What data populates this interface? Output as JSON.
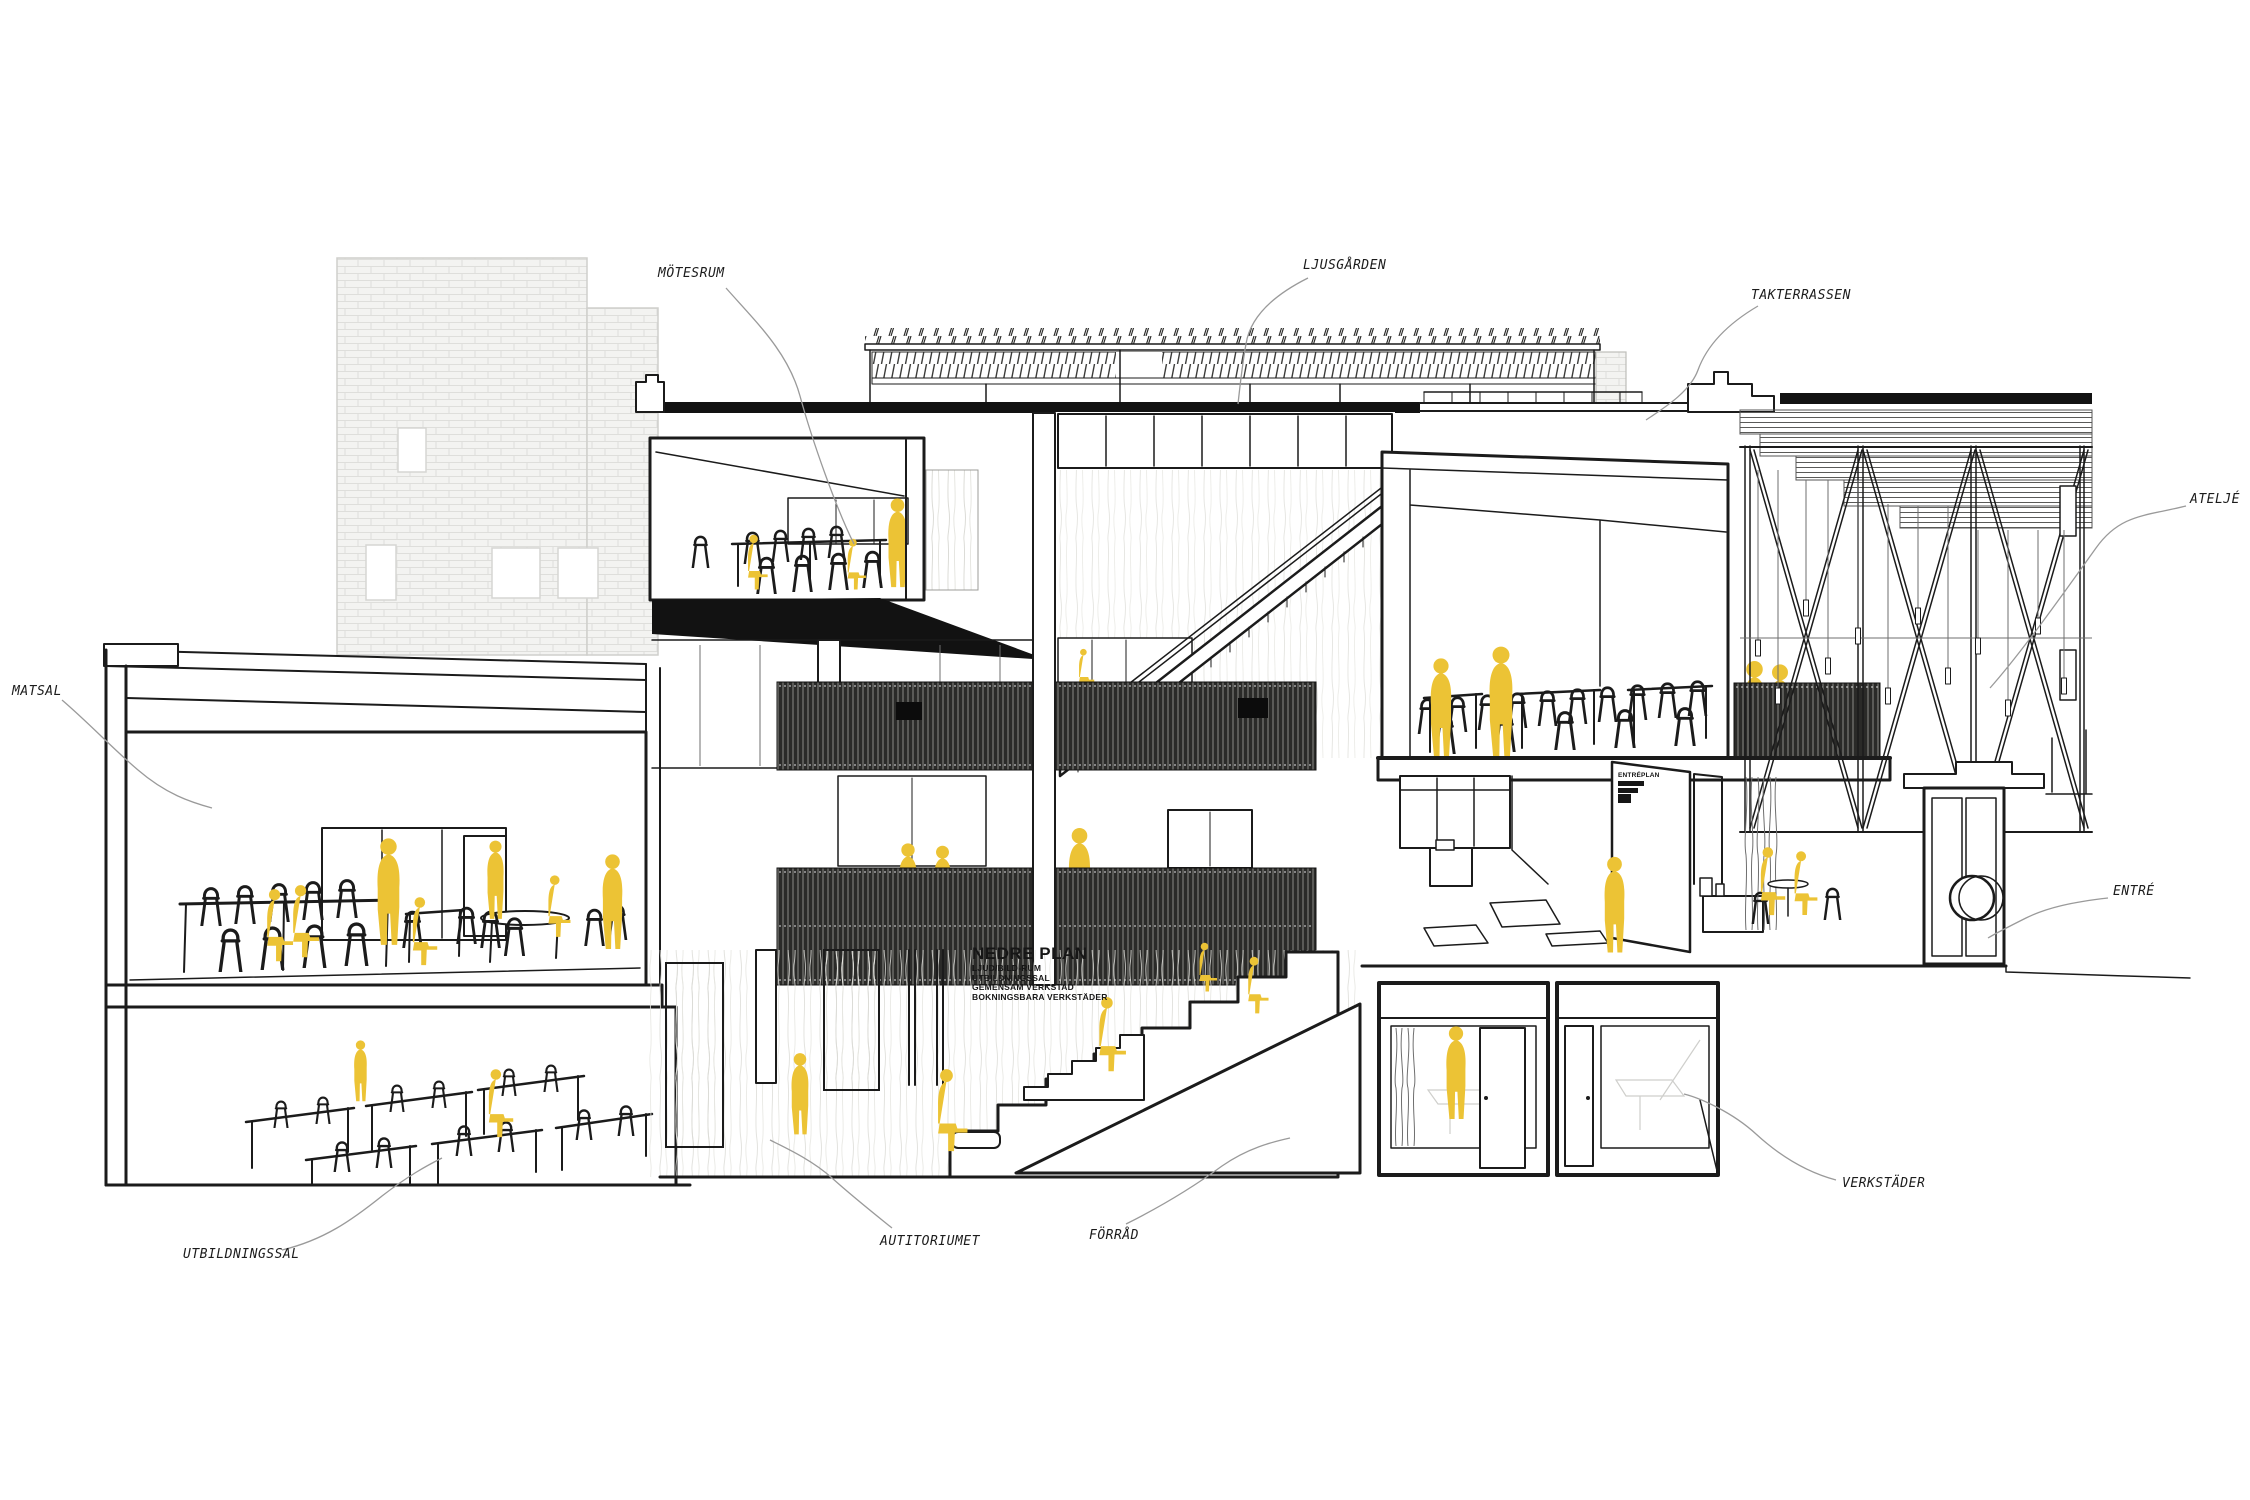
{
  "colors": {
    "accent": "#ecc335",
    "line": "#1b1b1b",
    "band": "#2a2a28",
    "leader": "#9a9a9a",
    "brick": "#f3f3f1"
  },
  "labels": [
    {
      "id": "matsal",
      "text": "MATSAL"
    },
    {
      "id": "motesrum",
      "text": "MÖTESRUM"
    },
    {
      "id": "ljusgarden",
      "text": "LJUSGÅRDEN"
    },
    {
      "id": "takterrassen",
      "text": "TAKTERRASSEN"
    },
    {
      "id": "atelje",
      "text": "ATELJÉ"
    },
    {
      "id": "entre",
      "text": "ENTRÉ"
    },
    {
      "id": "utbildningssal",
      "text": "UTBILDNINGSSAL"
    },
    {
      "id": "autitoriumet",
      "text": "AUTITORIUMET"
    },
    {
      "id": "forrad",
      "text": "FÖRRÅD"
    },
    {
      "id": "verkstader",
      "text": "VERKSTÄDER"
    }
  ],
  "plan_block": {
    "title": "NEDRE PLAN",
    "items": [
      "LJUD/BILD-RUM",
      "UTBILDNINGSSAL",
      "GEMENSAM VERKSTAD",
      "BOKNINGSBARA VERKSTÄDER"
    ]
  },
  "entre_block": {
    "title": "ENTRÉPLAN"
  }
}
